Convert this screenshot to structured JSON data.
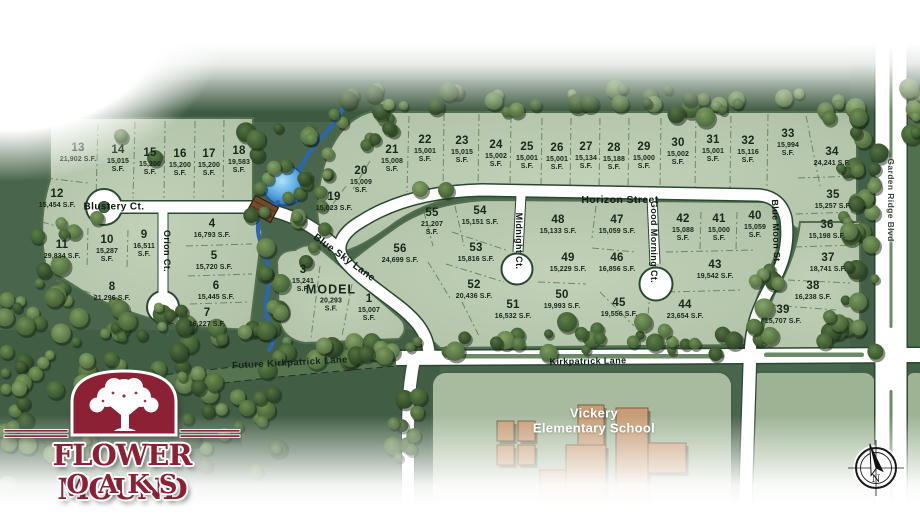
{
  "branding": {
    "line1": "FLOWER MOUND",
    "line2": "OAKS"
  },
  "school": {
    "line1": "Vickery",
    "line2": "Elementary School"
  },
  "compass": {
    "north_label": "N"
  },
  "colors": {
    "logo_maroon": "#8c2136",
    "lot_green": "#b8c8af",
    "ground_green": "#49654b",
    "canopy_green": "#2e4a2c",
    "road_white": "#ffffff",
    "water_blue": "#2b66b4",
    "building_tan": "#c69d76",
    "label_dark": "#17271a"
  },
  "streets": [
    {
      "name": "Blustery Ct.",
      "x": 114,
      "y": 207,
      "rot": 0,
      "fs": 10,
      "style": "road"
    },
    {
      "name": "Orion Ct.",
      "x": 167,
      "y": 251,
      "rot": 90,
      "fs": 9,
      "style": "road"
    },
    {
      "name": "Blue Sky Lane",
      "x": 344,
      "y": 258,
      "rot": 36,
      "fs": 10,
      "style": "road"
    },
    {
      "name": "Horizon Street",
      "x": 620,
      "y": 200,
      "rot": 0,
      "fs": 10.5,
      "style": "road"
    },
    {
      "name": "Midnight Ct.",
      "x": 519,
      "y": 241,
      "rot": 90,
      "fs": 9,
      "style": "road"
    },
    {
      "name": "Good Morning Ct.",
      "x": 654,
      "y": 242,
      "rot": 90,
      "fs": 9,
      "style": "road"
    },
    {
      "name": "Blue Moon St.",
      "x": 776,
      "y": 232,
      "rot": 88,
      "fs": 9,
      "style": "road"
    },
    {
      "name": "Future Kirkpatrick Lane",
      "x": 290,
      "y": 363,
      "rot": -3,
      "fs": 9.5,
      "style": "green"
    },
    {
      "name": "Kirkpatrick Lane",
      "x": 588,
      "y": 361,
      "rot": -1,
      "fs": 9,
      "style": "road"
    },
    {
      "name": "Garden Ridge Blvd",
      "x": 891,
      "y": 200,
      "rot": 90,
      "fs": 8.5,
      "style": "blvd"
    }
  ],
  "lots": [
    {
      "n": "1",
      "sf": "15,007 S.F.",
      "x": 369,
      "y": 309,
      "s": 1
    },
    {
      "n": "MODEL",
      "sf": "20,293 S.F.",
      "x": 331,
      "y": 299,
      "s": 1,
      "model": 1
    },
    {
      "n": "3",
      "sf": "15,241 S.F.",
      "x": 303,
      "y": 280,
      "s": 1
    },
    {
      "n": "4",
      "sf": "16,793 S.F.",
      "x": 212,
      "y": 229
    },
    {
      "n": "5",
      "sf": "15,720 S.F.",
      "x": 214,
      "y": 261
    },
    {
      "n": "6",
      "sf": "15,445 S.F.",
      "x": 216,
      "y": 291
    },
    {
      "n": "7",
      "sf": "16,227 S.F.",
      "x": 207,
      "y": 318
    },
    {
      "n": "8",
      "sf": "21,296 S.F.",
      "x": 112,
      "y": 292
    },
    {
      "n": "9",
      "sf": "16,511 S.F.",
      "x": 144,
      "y": 245,
      "s": 1
    },
    {
      "n": "10",
      "sf": "15,287 S.F.",
      "x": 107,
      "y": 250,
      "s": 1
    },
    {
      "n": "11",
      "sf": "29,834 S.F.",
      "x": 62,
      "y": 250
    },
    {
      "n": "12",
      "sf": "15,454 S.F.",
      "x": 57,
      "y": 199
    },
    {
      "n": "13",
      "sf": "21,902 S.F.",
      "x": 78,
      "y": 153
    },
    {
      "n": "14",
      "sf": "15,015 S.F.",
      "x": 118,
      "y": 160,
      "s": 1
    },
    {
      "n": "15",
      "sf": "15,200 S.F.",
      "x": 150,
      "y": 163,
      "s": 1
    },
    {
      "n": "16",
      "sf": "15,200 S.F.",
      "x": 180,
      "y": 164,
      "s": 1
    },
    {
      "n": "17",
      "sf": "15,200 S.F.",
      "x": 209,
      "y": 164,
      "s": 1
    },
    {
      "n": "18",
      "sf": "19,583 S.F.",
      "x": 239,
      "y": 161,
      "s": 1
    },
    {
      "n": "19",
      "sf": "15,023 S.F.",
      "x": 334,
      "y": 202
    },
    {
      "n": "20",
      "sf": "15,009 S.F.",
      "x": 361,
      "y": 181,
      "s": 1
    },
    {
      "n": "21",
      "sf": "15,008 S.F.",
      "x": 392,
      "y": 160,
      "s": 1
    },
    {
      "n": "22",
      "sf": "15,001 S.F.",
      "x": 425,
      "y": 150,
      "s": 1
    },
    {
      "n": "23",
      "sf": "15,015 S.F.",
      "x": 462,
      "y": 151,
      "s": 1
    },
    {
      "n": "24",
      "sf": "15,002 S.F.",
      "x": 496,
      "y": 155,
      "s": 1
    },
    {
      "n": "25",
      "sf": "15,001 S.F.",
      "x": 527,
      "y": 157,
      "s": 1
    },
    {
      "n": "26",
      "sf": "15,001 S.F.",
      "x": 557,
      "y": 158,
      "s": 1
    },
    {
      "n": "27",
      "sf": "15,134 S.F.",
      "x": 586,
      "y": 157,
      "s": 1
    },
    {
      "n": "28",
      "sf": "15,188 S.F.",
      "x": 614,
      "y": 158,
      "s": 1
    },
    {
      "n": "29",
      "sf": "15,000 S.F.",
      "x": 644,
      "y": 157,
      "s": 1
    },
    {
      "n": "30",
      "sf": "15,002 S.F.",
      "x": 678,
      "y": 153,
      "s": 1
    },
    {
      "n": "31",
      "sf": "15,001 S.F.",
      "x": 713,
      "y": 150,
      "s": 1
    },
    {
      "n": "32",
      "sf": "15,116 S.F.",
      "x": 748,
      "y": 151,
      "s": 1
    },
    {
      "n": "33",
      "sf": "15,994 S.F.",
      "x": 788,
      "y": 144,
      "s": 1
    },
    {
      "n": "34",
      "sf": "24,241 S.F.",
      "x": 832,
      "y": 157
    },
    {
      "n": "35",
      "sf": "15,257 S.F.",
      "x": 833,
      "y": 200
    },
    {
      "n": "36",
      "sf": "15,198 S.F.",
      "x": 827,
      "y": 230
    },
    {
      "n": "37",
      "sf": "18,741 S.F.",
      "x": 828,
      "y": 263
    },
    {
      "n": "38",
      "sf": "16,238 S.F.",
      "x": 813,
      "y": 291
    },
    {
      "n": "39",
      "sf": "15,707 S.F.",
      "x": 783,
      "y": 315
    },
    {
      "n": "40",
      "sf": "15,059 S.F.",
      "x": 755,
      "y": 226,
      "s": 1
    },
    {
      "n": "41",
      "sf": "15,000 S.F.",
      "x": 719,
      "y": 229,
      "s": 1
    },
    {
      "n": "42",
      "sf": "15,088 S.F.",
      "x": 683,
      "y": 229,
      "s": 1
    },
    {
      "n": "43",
      "sf": "19,542 S.F.",
      "x": 715,
      "y": 270
    },
    {
      "n": "44",
      "sf": "23,654 S.F.",
      "x": 685,
      "y": 310
    },
    {
      "n": "45",
      "sf": "19,556 S.F.",
      "x": 619,
      "y": 308
    },
    {
      "n": "46",
      "sf": "16,856 S.F.",
      "x": 617,
      "y": 263
    },
    {
      "n": "47",
      "sf": "15,059 S.F.",
      "x": 617,
      "y": 225
    },
    {
      "n": "48",
      "sf": "15,133 S.F.",
      "x": 558,
      "y": 225
    },
    {
      "n": "49",
      "sf": "15,229 S.F.",
      "x": 568,
      "y": 263
    },
    {
      "n": "50",
      "sf": "19,993 S.F.",
      "x": 562,
      "y": 300
    },
    {
      "n": "51",
      "sf": "16,532 S.F.",
      "x": 513,
      "y": 310
    },
    {
      "n": "52",
      "sf": "20,436 S.F.",
      "x": 474,
      "y": 290
    },
    {
      "n": "53",
      "sf": "15,816 S.F.",
      "x": 476,
      "y": 253
    },
    {
      "n": "54",
      "sf": "15,151 S.F.",
      "x": 480,
      "y": 216
    },
    {
      "n": "55",
      "sf": "21,207 S.F.",
      "x": 432,
      "y": 223,
      "s": 1
    },
    {
      "n": "56",
      "sf": "24,699 S.F.",
      "x": 400,
      "y": 254
    }
  ]
}
